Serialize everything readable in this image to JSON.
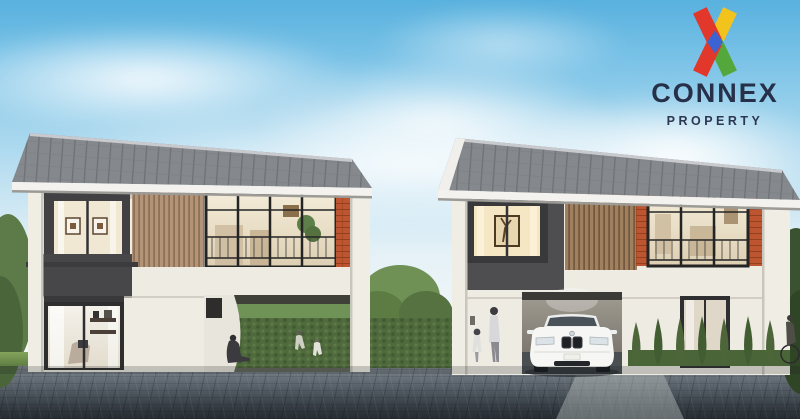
{
  "brand": {
    "name": "CONNEX",
    "subtitle": "PROPERTY",
    "logo_icon": "x-mark",
    "colors": {
      "red": "#e2372b",
      "yellow": "#f2c31d",
      "green": "#54a83b",
      "blue": "#3b63d1",
      "navy": "#273049"
    }
  },
  "scene": {
    "objects": [
      "sky-with-clouds",
      "left-two-storey-house",
      "right-two-storey-house",
      "white-sedan-in-carport",
      "garden-hedges-and-trees",
      "paved-driveway",
      "resident-figures"
    ],
    "palette": {
      "sky_top": "#58b1de",
      "roof_grey": "#85888c",
      "dark_wall": "#4c4c4e",
      "wood_slats": "#b29376",
      "brick_accent": "#bc5530",
      "white_wall": "#efece3",
      "hedge_green": "#4f6a3c",
      "pavement_dark": "#343b42"
    }
  }
}
